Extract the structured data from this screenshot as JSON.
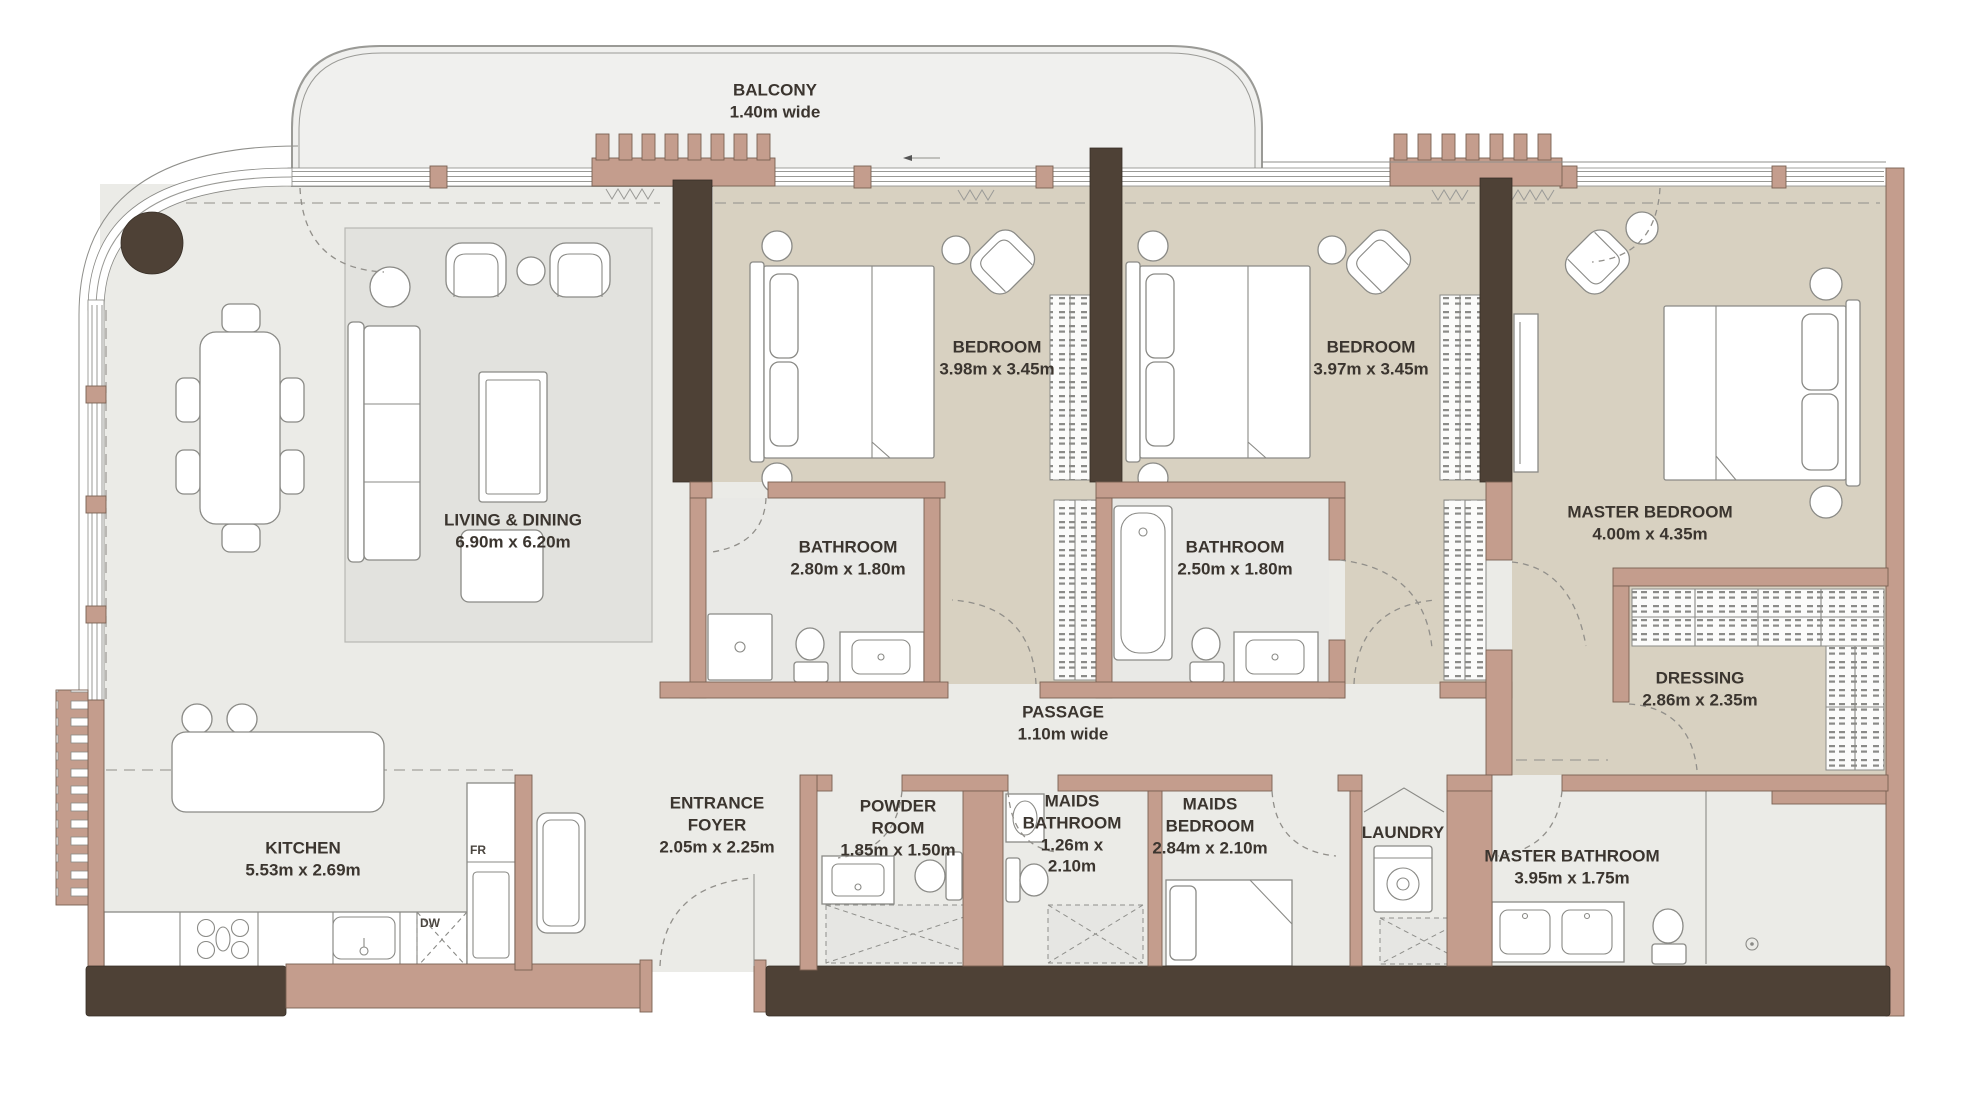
{
  "rooms": {
    "balcony": {
      "name": "BALCONY",
      "dims": "1.40m wide"
    },
    "living": {
      "name": "LIVING & DINING",
      "dims": "6.90m x 6.20m"
    },
    "kitchen": {
      "name": "KITCHEN",
      "dims": "5.53m x 2.69m"
    },
    "bedroom1": {
      "name": "BEDROOM",
      "dims": "3.98m x 3.45m"
    },
    "bedroom2": {
      "name": "BEDROOM",
      "dims": "3.97m x 3.45m"
    },
    "master_bedroom": {
      "name": "MASTER BEDROOM",
      "dims": "4.00m x 4.35m"
    },
    "bathroom1": {
      "name": "BATHROOM",
      "dims": "2.80m x 1.80m"
    },
    "bathroom2": {
      "name": "BATHROOM",
      "dims": "2.50m x 1.80m"
    },
    "passage": {
      "name": "PASSAGE",
      "dims": "1.10m wide"
    },
    "dressing": {
      "name": "DRESSING",
      "dims": "2.86m x 2.35m"
    },
    "entrance_foyer": {
      "name": "ENTRANCE FOYER",
      "dims": "2.05m x 2.25m"
    },
    "powder_room": {
      "name": "POWDER ROOM",
      "dims": "1.85m x 1.50m"
    },
    "maids_bathroom": {
      "name": "MAIDS BATHROOM",
      "dims": "1.26m x 2.10m"
    },
    "maids_bedroom": {
      "name": "MAIDS BEDROOM",
      "dims": "2.84m x 2.10m"
    },
    "laundry": {
      "name": "LAUNDRY",
      "dims": ""
    },
    "master_bathroom": {
      "name": "MASTER BATHROOM",
      "dims": "3.95m x 1.75m"
    }
  },
  "appliances": {
    "fridge": "FR",
    "dishwasher": "DW"
  },
  "colors": {
    "wall": "#c49d8d",
    "wall_stroke": "#7a6153",
    "dark_wall": "#4e4136",
    "bedroom_floor": "#d8d1c1",
    "living_floor": "#ebebe7",
    "bath_floor": "#e9e9e6",
    "balcony_floor": "#f0f0ee",
    "rug": "#e2e2de",
    "line": "#8f8f8b",
    "furniture_stroke": "#8a8a86",
    "text": "#3b352f"
  }
}
